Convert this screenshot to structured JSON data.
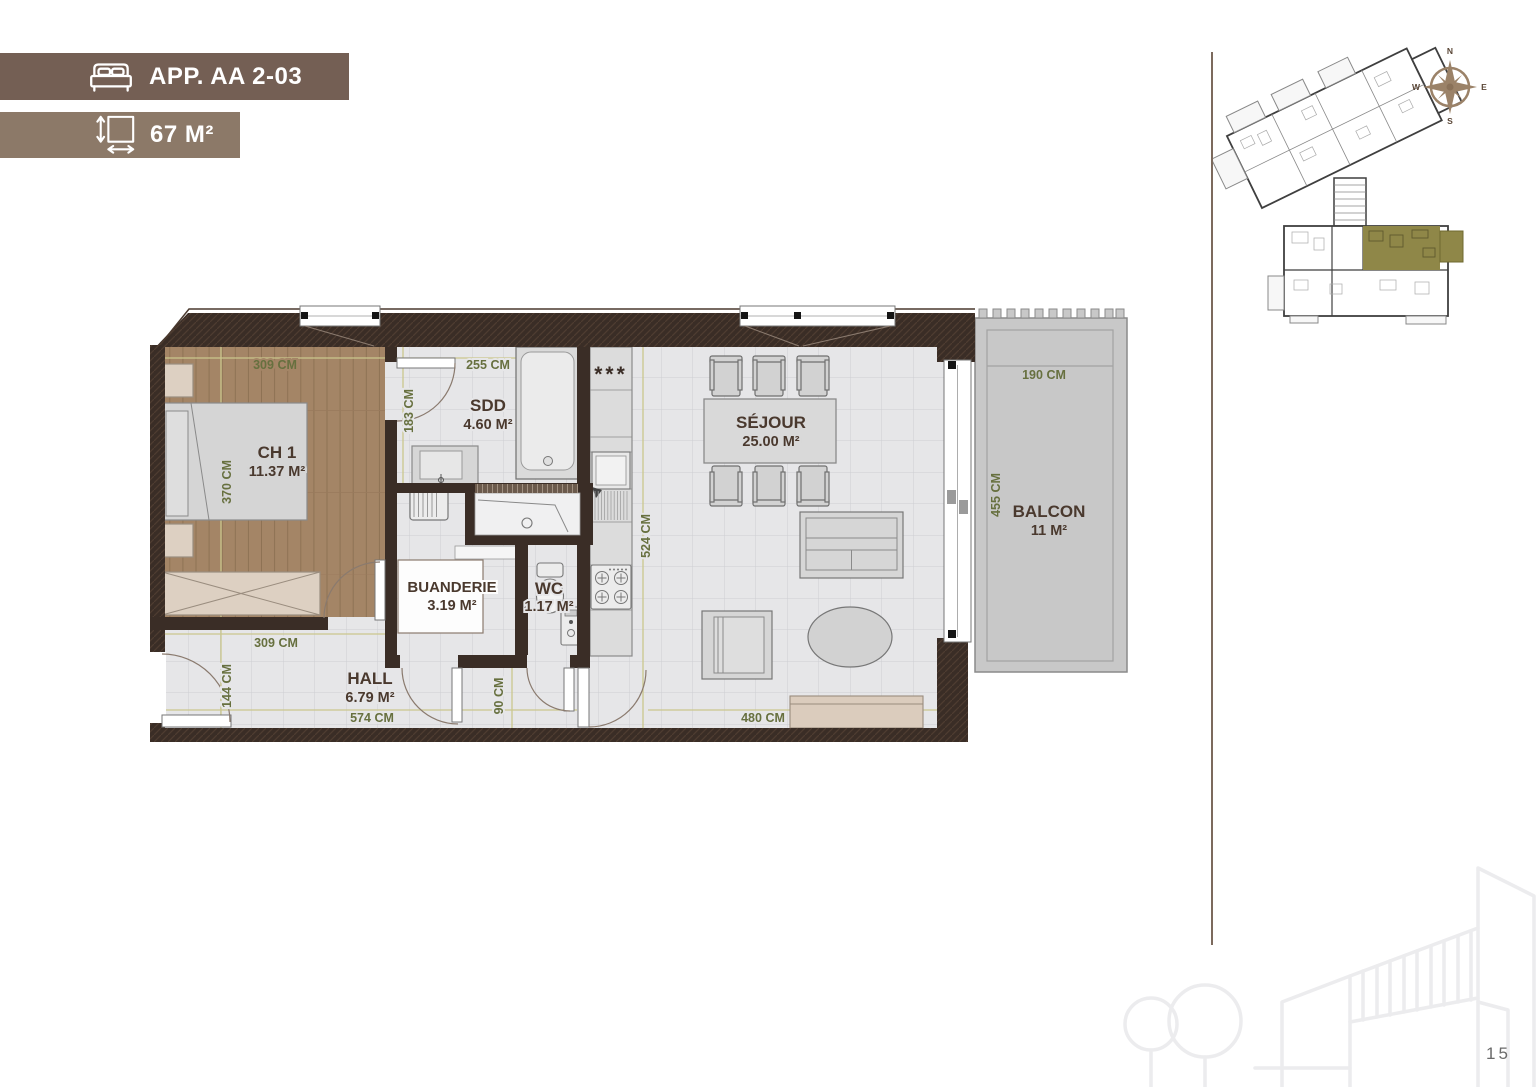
{
  "header": {
    "apartment_label": "APP. AA 2-03",
    "area_label": "67 M²"
  },
  "rooms": {
    "ch1": {
      "name": "CH 1",
      "area": "11.37 M²"
    },
    "sdd": {
      "name": "SDD",
      "area": "4.60 M²"
    },
    "buanderie": {
      "name": "BUANDERIE",
      "area": "3.19 M²"
    },
    "wc": {
      "name": "WC",
      "area": "1.17 M²"
    },
    "hall": {
      "name": "HALL",
      "area": "6.79 M²"
    },
    "sejour": {
      "name": "SÉJOUR",
      "area": "25.00 M²"
    },
    "balcon": {
      "name": "BALCON",
      "area": "11 M²"
    }
  },
  "dimensions": {
    "ch1_width": "309 CM",
    "ch1_height": "370 CM",
    "sdd_width": "255 CM",
    "sdd_height": "183 CM",
    "sejour_height": "524 CM",
    "sejour_width": "480 CM",
    "hall_width_top": "309 CM",
    "hall_height": "144 CM",
    "hall_width": "574 CM",
    "wc_width": "90 CM",
    "balcon_width": "190 CM",
    "balcon_height": "455 CM"
  },
  "kitchen": {
    "freezer_symbol": "***"
  },
  "compass": {
    "north": "N",
    "east": "E",
    "south": "S",
    "west": "W"
  },
  "page_number": "15",
  "colors": {
    "banner_dark": "#745f54",
    "banner_light": "#8c7968",
    "wall": "#3a2d26",
    "wood_floor": "#a48566",
    "tile_floor": "#e6e6e8",
    "balcony": "#c8c8c8",
    "dim_text": "#67703f",
    "label_text": "#4a392e",
    "highlight_unit": "#8f8748"
  }
}
